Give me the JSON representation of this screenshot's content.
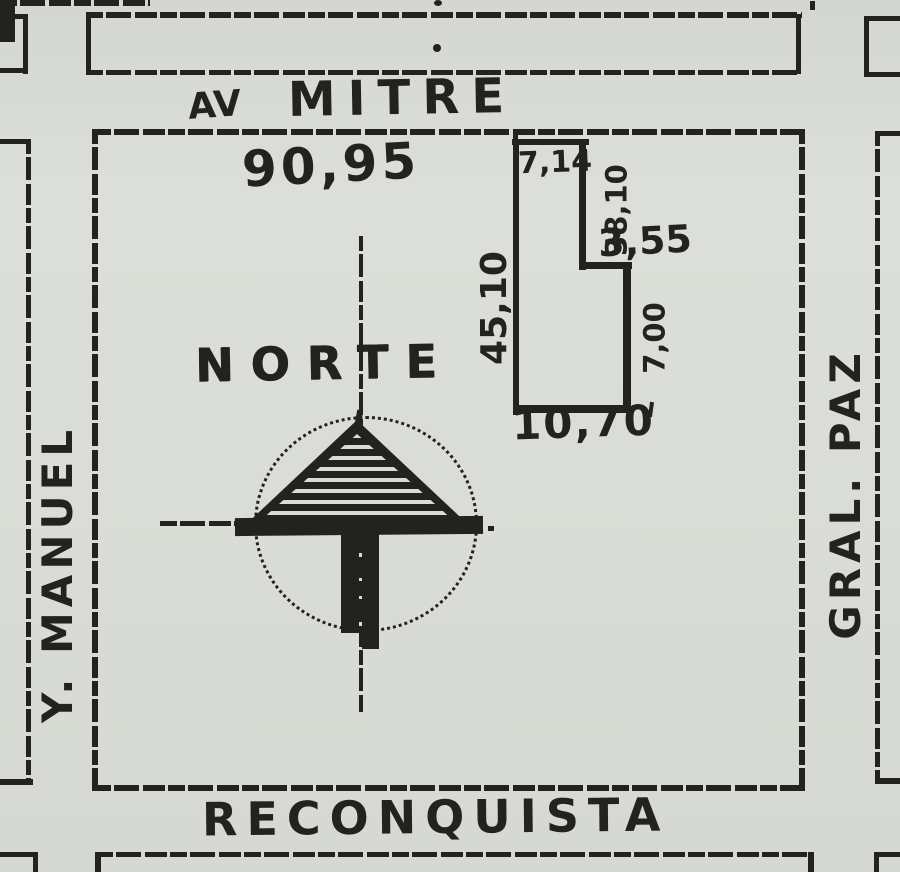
{
  "map": {
    "type": "hand-drawn location sketch (croquis) of a city block and lot",
    "streets": {
      "top_prefix": "AV",
      "top_name": "MITRE",
      "bottom_name": "RECONQUISTA",
      "left_name": "Y. MANUEL",
      "right_name": "GRAL. PAZ"
    },
    "north_label": "NORTE",
    "block_front_label": "90,95",
    "lot_dims": {
      "front": "7,14",
      "side_upper_right": "38,10",
      "step": "3,55",
      "side_left": "45,10",
      "side_lower_right": "7,00",
      "rear": "10,70"
    },
    "colors": {
      "paper": "#d9dbd6",
      "ink": "#222220"
    }
  }
}
